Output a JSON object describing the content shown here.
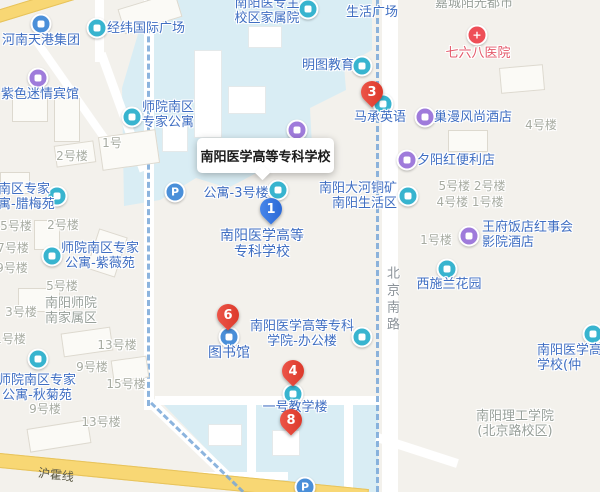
{
  "title_box": {
    "label": "南阳医学高等专科学校"
  },
  "colors": {
    "background": "#f3f1ec",
    "campus_area": "#d9edf4",
    "road_yellow": "#f8d774",
    "marker_red": "#e0442f",
    "marker_blue": "#3574e3",
    "poi_label_blue": "#3f6ec2",
    "building_label_gray": "#a7aba1",
    "hospital_label_red": "#e45a6b",
    "boundary_dash_blue": "#79a8d9"
  },
  "road_labels": [
    {
      "name": "hu-huo-line-label",
      "text": "沪霍线",
      "x": 38,
      "y": 466,
      "rotate": 7,
      "vertical": false
    },
    {
      "name": "beijing-south-road-label",
      "text": "北京南路",
      "x": 382,
      "y": 266,
      "rotate": 0,
      "vertical": true
    }
  ],
  "markers": [
    {
      "num": "1",
      "color": "blue",
      "x": 271,
      "y": 209
    },
    {
      "num": "3",
      "color": "red",
      "x": 372,
      "y": 92
    },
    {
      "num": "4",
      "color": "red",
      "x": 293,
      "y": 371
    },
    {
      "num": "6",
      "color": "red",
      "x": 228,
      "y": 315
    },
    {
      "num": "8",
      "color": "red",
      "x": 291,
      "y": 420
    }
  ],
  "poi_icons": [
    {
      "name": "company-icon",
      "color": "blue",
      "glyph": "blk",
      "x": 41,
      "y": 24
    },
    {
      "name": "plaza-icon",
      "color": "teal",
      "glyph": "blk",
      "x": 97,
      "y": 28
    },
    {
      "name": "hotel-icon",
      "color": "purple",
      "glyph": "blk",
      "x": 38,
      "y": 78
    },
    {
      "name": "apartment-icon",
      "color": "teal",
      "glyph": "blk",
      "x": 132,
      "y": 117
    },
    {
      "name": "apartment-icon",
      "color": "teal",
      "glyph": "blk",
      "x": 57,
      "y": 196
    },
    {
      "name": "apartment-icon",
      "color": "teal",
      "glyph": "blk",
      "x": 52,
      "y": 256
    },
    {
      "name": "apartment-icon",
      "color": "teal",
      "glyph": "blk",
      "x": 38,
      "y": 359
    },
    {
      "name": "parking-icon",
      "color": "blue",
      "glyph": "P",
      "x": 175,
      "y": 192
    },
    {
      "name": "parking-icon",
      "color": "blue",
      "glyph": "P",
      "x": 305,
      "y": 487
    },
    {
      "name": "residence-icon",
      "color": "teal",
      "glyph": "blk",
      "x": 308,
      "y": 9
    },
    {
      "name": "education-icon",
      "color": "teal",
      "glyph": "blk",
      "x": 362,
      "y": 66
    },
    {
      "name": "education-icon",
      "color": "teal",
      "glyph": "blk",
      "x": 383,
      "y": 104
    },
    {
      "name": "hotel-icon",
      "color": "purple",
      "glyph": "blk",
      "x": 425,
      "y": 117
    },
    {
      "name": "store-icon",
      "color": "purple",
      "glyph": "blk",
      "x": 407,
      "y": 160
    },
    {
      "name": "residence-icon",
      "color": "teal",
      "glyph": "blk",
      "x": 408,
      "y": 196
    },
    {
      "name": "hotel-icon",
      "color": "purple",
      "glyph": "blk",
      "x": 469,
      "y": 236
    },
    {
      "name": "garden-icon",
      "color": "teal",
      "glyph": "blk",
      "x": 447,
      "y": 269
    },
    {
      "name": "hospital-icon",
      "color": "redc",
      "glyph": "+",
      "x": 477,
      "y": 35
    },
    {
      "name": "library-icon",
      "color": "blue",
      "glyph": "blk",
      "x": 229,
      "y": 337
    },
    {
      "name": "office-icon",
      "color": "teal",
      "glyph": "blk",
      "x": 362,
      "y": 337
    },
    {
      "name": "school-icon",
      "color": "teal",
      "glyph": "blk",
      "x": 293,
      "y": 394
    },
    {
      "name": "school-icon",
      "color": "teal",
      "glyph": "blk",
      "x": 593,
      "y": 334
    },
    {
      "name": "school-icon",
      "color": "purple",
      "glyph": "blk",
      "x": 297,
      "y": 130
    },
    {
      "name": "apartment-icon",
      "color": "teal",
      "glyph": "blk",
      "x": 278,
      "y": 190
    }
  ],
  "poi_labels": [
    {
      "name": "henan-tiangang-group",
      "lines": [
        "河南天港集团"
      ],
      "x": 41,
      "y": 33,
      "a": "c",
      "cls": "blue"
    },
    {
      "name": "jingwei-intl-plaza",
      "lines": [
        "经纬国际广场"
      ],
      "x": 146,
      "y": 21,
      "a": "c",
      "cls": "blue"
    },
    {
      "name": "zise-miqing-hotel",
      "lines": [
        "紫色迷情宾馆"
      ],
      "x": 40,
      "y": 87,
      "a": "c",
      "cls": "blue"
    },
    {
      "name": "shiyuan-south-expert-apartment",
      "lines": [
        "师院南区",
        "专家公寓"
      ],
      "x": 168,
      "y": 100,
      "a": "c",
      "cls": "blue"
    },
    {
      "name": "lameiyuan-apartment",
      "lines": [
        "南区专家",
        "寓-腊梅苑"
      ],
      "x": -2,
      "y": 182,
      "a": "l",
      "cls": "blue"
    },
    {
      "name": "ziweiyuan-apartment",
      "lines": [
        "师院南区专家",
        "公寓-紫薇苑"
      ],
      "x": 100,
      "y": 241,
      "a": "c",
      "cls": "blue"
    },
    {
      "name": "nanyang-shiyuan-family-area",
      "lines": [
        "南阳师院",
        "南家属区"
      ],
      "x": 71,
      "y": 296,
      "a": "c",
      "cls": "graylg"
    },
    {
      "name": "qiujuyuan-apartment",
      "lines": [
        "师院南区专家",
        "公寓-秋菊苑"
      ],
      "x": 37,
      "y": 373,
      "a": "c",
      "cls": "blue"
    },
    {
      "name": "apartment-building-3",
      "lines": [
        "公寓-3号楼"
      ],
      "x": 236,
      "y": 186,
      "a": "c",
      "cls": "blue"
    },
    {
      "name": "yizhuan-main-campus-family-area",
      "lines": [
        "南阳医专主",
        "校区家属院"
      ],
      "x": 267,
      "y": -4,
      "a": "c",
      "cls": "blue"
    },
    {
      "name": "life-plaza",
      "lines": [
        "生活广场"
      ],
      "x": 372,
      "y": 5,
      "a": "c",
      "cls": "blue"
    },
    {
      "name": "mingtu-education",
      "lines": [
        "明图教育"
      ],
      "x": 328,
      "y": 58,
      "a": "c",
      "cls": "blue"
    },
    {
      "name": "macheng-english",
      "lines": [
        "马承英语"
      ],
      "x": 380,
      "y": 110,
      "a": "c",
      "cls": "blue"
    },
    {
      "name": "chaoman-fashion-hotel",
      "lines": [
        "巢漫风尚酒店"
      ],
      "x": 473,
      "y": 110,
      "a": "c",
      "cls": "blue"
    },
    {
      "name": "xiyanghong-store",
      "lines": [
        "夕阳红便利店"
      ],
      "x": 456,
      "y": 153,
      "a": "c",
      "cls": "blue"
    },
    {
      "name": "dahe-copper-mine-living-area",
      "lines": [
        "南阳大河铜矿",
        "南阳生活区"
      ],
      "x": 397,
      "y": 181,
      "a": "r",
      "cls": "blue"
    },
    {
      "name": "wangfu-hotel-cinema",
      "lines": [
        "王府饭店红事会",
        "影院酒店"
      ],
      "x": 482,
      "y": 220,
      "a": "l",
      "cls": "blue"
    },
    {
      "name": "xishilan-garden",
      "lines": [
        "西施兰花园"
      ],
      "x": 449,
      "y": 277,
      "a": "c",
      "cls": "blue"
    },
    {
      "name": "nanyang-medical-college-label",
      "lines": [
        "南阳医学高等",
        "专科学校"
      ],
      "x": 262,
      "y": 228,
      "a": "c",
      "cls": "blue big"
    },
    {
      "name": "library-label",
      "lines": [
        "图书馆"
      ],
      "x": 229,
      "y": 345,
      "a": "c",
      "cls": "blue big"
    },
    {
      "name": "office-building-label",
      "lines": [
        "南阳医学高等专科",
        "学院-办公楼"
      ],
      "x": 302,
      "y": 319,
      "a": "c",
      "cls": "blue"
    },
    {
      "name": "teaching-building-1-label",
      "lines": [
        "一号教学楼"
      ],
      "x": 295,
      "y": 400,
      "a": "c",
      "cls": "blue"
    },
    {
      "name": "zhongjing-campus-label",
      "lines": [
        "南阳医学高",
        "学校(仲"
      ],
      "x": 537,
      "y": 343,
      "a": "l",
      "cls": "blue"
    },
    {
      "name": "768-hospital-label",
      "lines": [
        "七六八医院"
      ],
      "x": 478,
      "y": 46,
      "a": "c",
      "cls": "red"
    },
    {
      "name": "jiacheng-sunshine-city",
      "lines": [
        "嘉城阳光都市"
      ],
      "x": 474,
      "y": -4,
      "a": "c",
      "cls": "graylg"
    },
    {
      "name": "nanyang-institute-of-technology",
      "lines": [
        "南阳理工学院",
        "(北京路校区)"
      ],
      "x": 515,
      "y": 409,
      "a": "c",
      "cls": "graylg"
    },
    {
      "name": "building-number-label",
      "lines": [
        "2号楼"
      ],
      "x": 72,
      "y": 149,
      "a": "c",
      "cls": "gray"
    },
    {
      "name": "building-number-label",
      "lines": [
        "1号"
      ],
      "x": 112,
      "y": 136,
      "a": "c",
      "cls": "gray"
    },
    {
      "name": "building-number-label",
      "lines": [
        "5号楼"
      ],
      "x": 16,
      "y": 219,
      "a": "c",
      "cls": "gray"
    },
    {
      "name": "building-number-label",
      "lines": [
        "2号楼"
      ],
      "x": 63,
      "y": 218,
      "a": "c",
      "cls": "gray"
    },
    {
      "name": "building-number-label",
      "lines": [
        "7号楼"
      ],
      "x": 13,
      "y": 241,
      "a": "c",
      "cls": "gray"
    },
    {
      "name": "building-number-label",
      "lines": [
        "9号楼"
      ],
      "x": 12,
      "y": 261,
      "a": "c",
      "cls": "gray"
    },
    {
      "name": "building-number-label",
      "lines": [
        "5号楼"
      ],
      "x": 62,
      "y": 279,
      "a": "c",
      "cls": "gray"
    },
    {
      "name": "building-number-label",
      "lines": [
        "3号楼"
      ],
      "x": 21,
      "y": 305,
      "a": "c",
      "cls": "gray"
    },
    {
      "name": "building-number-label",
      "lines": [
        "1号楼"
      ],
      "x": 10,
      "y": 332,
      "a": "c",
      "cls": "gray"
    },
    {
      "name": "building-number-label",
      "lines": [
        "13号楼"
      ],
      "x": 117,
      "y": 338,
      "a": "c",
      "cls": "gray"
    },
    {
      "name": "building-number-label",
      "lines": [
        "9号楼"
      ],
      "x": 92,
      "y": 360,
      "a": "c",
      "cls": "gray"
    },
    {
      "name": "building-number-label",
      "lines": [
        "15号楼"
      ],
      "x": 126,
      "y": 377,
      "a": "c",
      "cls": "gray"
    },
    {
      "name": "building-number-label",
      "lines": [
        "9号楼"
      ],
      "x": 45,
      "y": 402,
      "a": "c",
      "cls": "gray"
    },
    {
      "name": "building-number-label",
      "lines": [
        "13号楼"
      ],
      "x": 101,
      "y": 415,
      "a": "c",
      "cls": "gray"
    },
    {
      "name": "building-number-label",
      "lines": [
        "4号楼"
      ],
      "x": 541,
      "y": 118,
      "a": "c",
      "cls": "gray"
    },
    {
      "name": "building-number-label",
      "lines": [
        "5号楼  2号楼"
      ],
      "x": 472,
      "y": 179,
      "a": "c",
      "cls": "gray"
    },
    {
      "name": "building-number-label",
      "lines": [
        "4号楼  1号楼"
      ],
      "x": 470,
      "y": 195,
      "a": "c",
      "cls": "gray"
    },
    {
      "name": "building-number-label",
      "lines": [
        "1号楼"
      ],
      "x": 436,
      "y": 233,
      "a": "c",
      "cls": "gray"
    }
  ]
}
